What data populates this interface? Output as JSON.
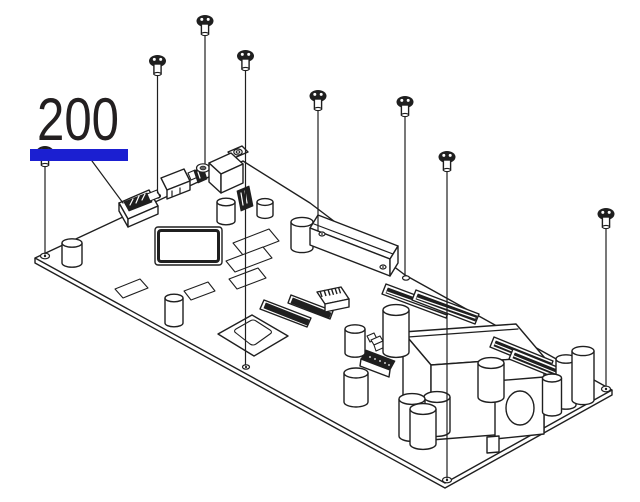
{
  "diagram": {
    "part_number": "200",
    "screw_count": 8,
    "colors": {
      "highlight": "#1b1fd1",
      "line": "#1f1f1f",
      "background": "#ffffff"
    }
  }
}
